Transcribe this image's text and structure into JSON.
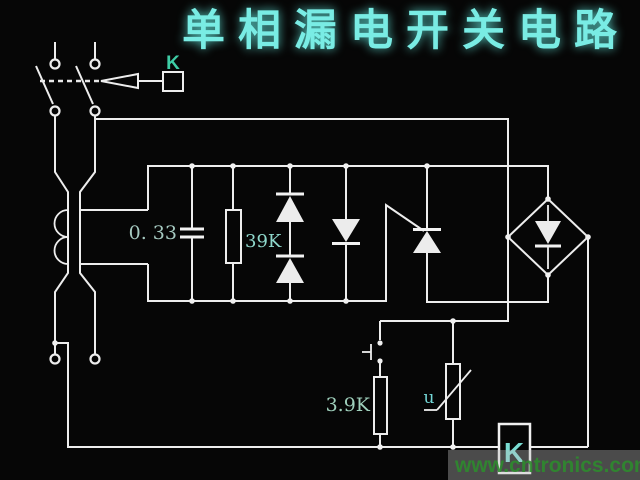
{
  "title": "单相漏电开关电路",
  "labels": {
    "relay_contact": "K",
    "capacitor_value": "0. 33",
    "resistor1_value": "39K",
    "resistor2_value": "3.9K",
    "varistor_label": "u",
    "relay_coil": "K"
  },
  "watermark": "www.cntronics.com",
  "colors": {
    "title": "#79ece4",
    "capacitor_label": "#a5c9c0",
    "resistor1_label": "#8fd8cc",
    "resistor2_label": "#9fd0bc",
    "varistor_text": "#74d8d8",
    "k_top": "#3ecca5",
    "k_coil": "#79dcd2",
    "watermark": "#2e8b2e"
  }
}
